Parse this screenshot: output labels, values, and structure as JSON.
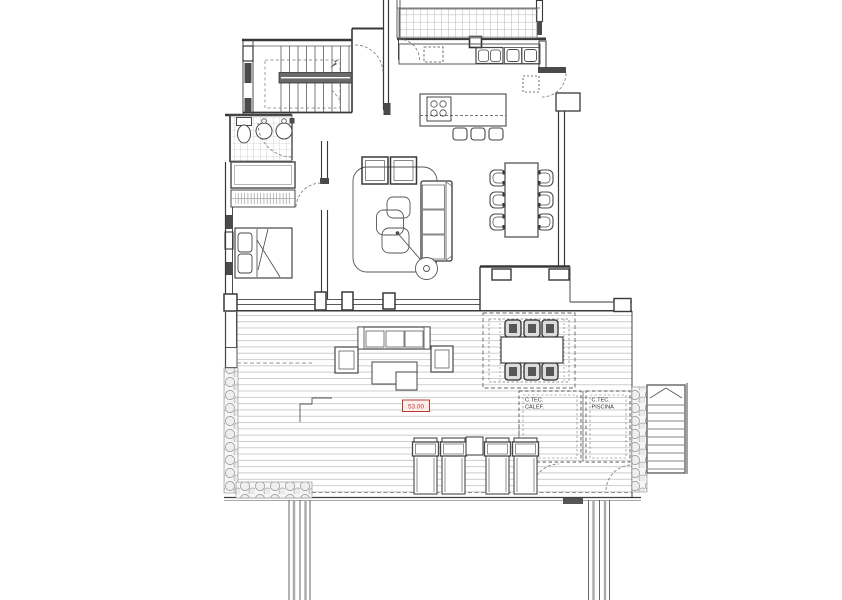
{
  "drawing": {
    "kind": "floor-plan",
    "level_mark": "53.00",
    "rooms": {
      "tech_heating_line1": "C.TEC.",
      "tech_heating_line2": "CALEF.",
      "tech_pool_line1": "C.TEC.",
      "tech_pool_line2": "PISCINA"
    },
    "symbols": [
      "staircase",
      "toilet",
      "washbasin",
      "wardrobe",
      "double-bed",
      "sofa",
      "armchair",
      "coffee-table",
      "floor-lamp",
      "dining-table-6-chairs",
      "kitchen-island",
      "cooktop",
      "bar-stool",
      "kitchen-counter-sink",
      "outdoor-sofa-set",
      "outdoor-dining-set",
      "sun-lounger",
      "exterior-staircase",
      "pebble-border",
      "deck-planks"
    ],
    "colors": {
      "line": "#474747",
      "wall_fill": "#4a4a4a",
      "light_line": "#c2c2c2",
      "grid_line": "#9a9a9a",
      "level_mark_red": "#c0392b",
      "level_mark_bg": "#fdeeee",
      "label_text": "#333333",
      "pebble_fill": "#efefef"
    }
  }
}
